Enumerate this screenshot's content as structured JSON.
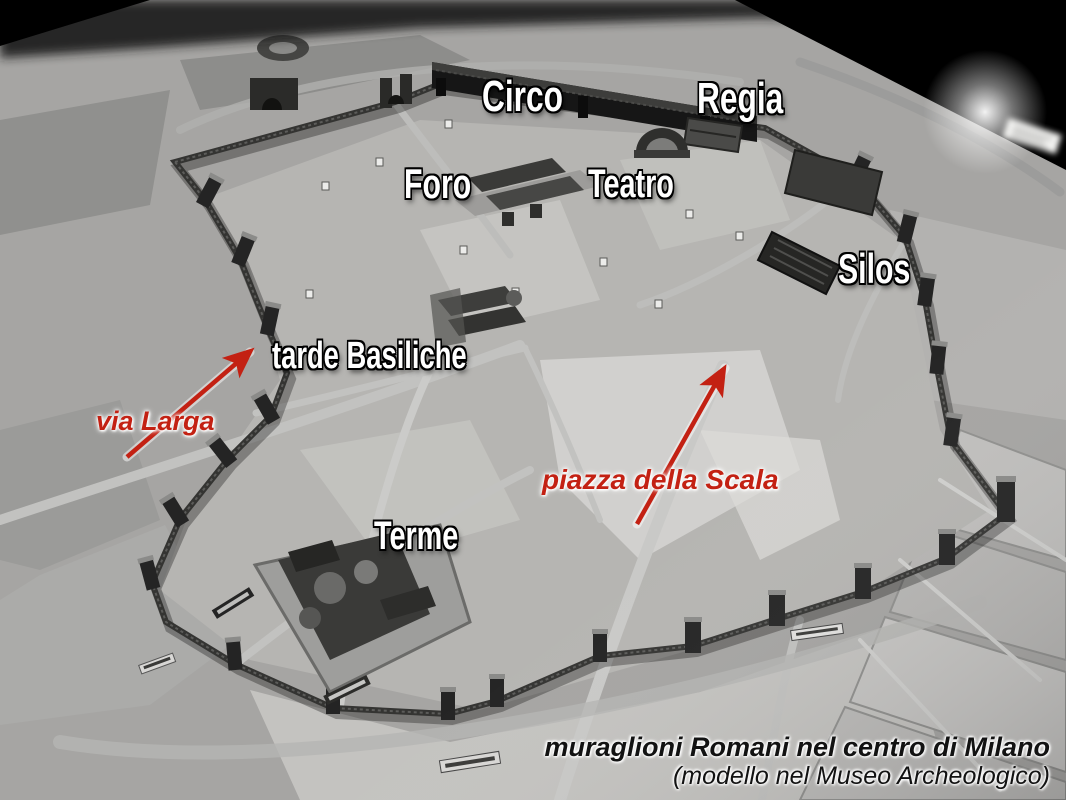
{
  "scene": {
    "description": "Black-and-white photograph of a museum scale model showing the Roman walls and monuments in the centre of Milan",
    "background_color": "#000000"
  },
  "monument_labels": [
    {
      "id": "circo",
      "text": "Circo"
    },
    {
      "id": "regia",
      "text": "Regia"
    },
    {
      "id": "foro",
      "text": "Foro"
    },
    {
      "id": "teatro",
      "text": "Teatro"
    },
    {
      "id": "silos",
      "text": "Silos"
    },
    {
      "id": "basiliche",
      "text": "tarde Basiliche"
    },
    {
      "id": "terme",
      "text": "Terme"
    }
  ],
  "street_annotations": [
    {
      "id": "via-larga",
      "text": "via Larga",
      "color": "#c32113",
      "has_arrow": true
    },
    {
      "id": "piazza-scala",
      "text": "piazza della Scala",
      "color": "#c32113",
      "has_arrow": true
    }
  ],
  "caption": {
    "line1": "muraglioni Romani nel centro di Milano",
    "line2": "(modello nel Museo Archeologico)"
  },
  "colors": {
    "annotation_red": "#c32113",
    "label_white": "#ffffff",
    "caption_black": "#121212"
  }
}
